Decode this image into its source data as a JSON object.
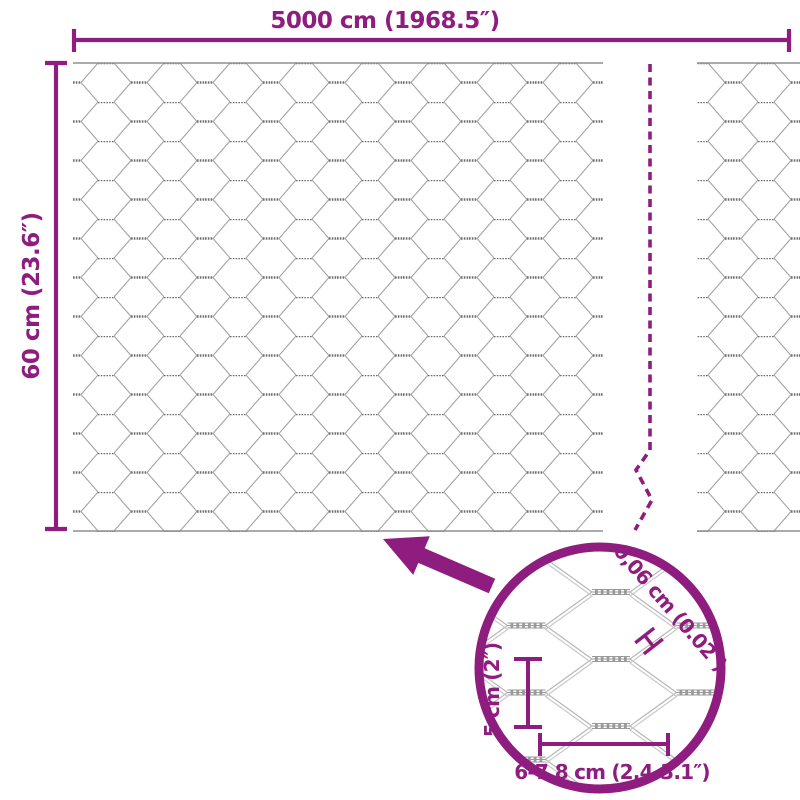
{
  "diagram": {
    "title_hint": "wire mesh fence dimension diagram",
    "dimensions": {
      "width_label": "5000 cm (1968.5″)",
      "height_label": "60 cm (23.6″)"
    },
    "detail": {
      "wire_thickness_label": "0,06 cm (0.02″)",
      "wire_thickness_marker": "H",
      "mesh_height_label": "5 cm (2″)",
      "mesh_width_label": "6-7,8 cm (2.4-3.1″)"
    },
    "colors": {
      "accent": "#8f1c7f",
      "mesh_line": "#a3a3a3",
      "mesh_twist": "#6f6f6f",
      "detail_mesh": "#9a9a9a"
    }
  }
}
